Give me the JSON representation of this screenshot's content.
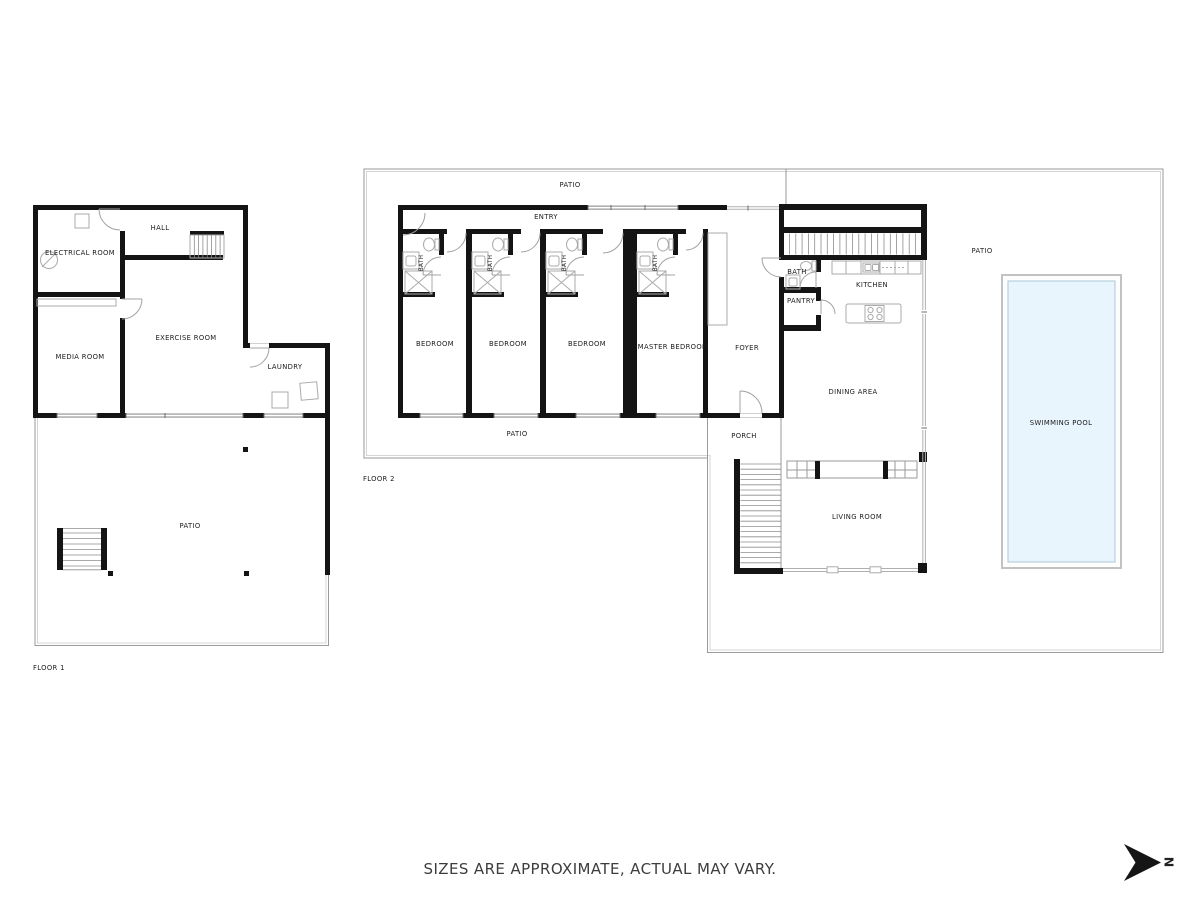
{
  "disclaimer": "SIZES ARE APPROXIMATE, ACTUAL MAY VARY.",
  "north": {
    "letter": "N"
  },
  "colors": {
    "wall": "#141414",
    "line": "#9a9a9a",
    "fixture": "#ababab",
    "pool_water": "#e9f5fc",
    "text": "#1b1b1b",
    "disclaimer": "#3d3d3d"
  },
  "floor1": {
    "label": "FLOOR 1",
    "rooms": {
      "electrical": "ELECTRICAL ROOM",
      "hall": "HALL",
      "media": "MEDIA ROOM",
      "exercise": "EXERCISE ROOM",
      "laundry": "LAUNDRY",
      "patio": "PATIO"
    }
  },
  "floor2": {
    "label": "FLOOR 2",
    "rooms": {
      "patio_top": "PATIO",
      "entry": "ENTRY",
      "bath1": "BATH",
      "bath2": "BATH",
      "bath3": "BATH",
      "bath4": "BATH",
      "bedroom1": "BEDROOM",
      "bedroom2": "BEDROOM",
      "bedroom3": "BEDROOM",
      "master_bedroom": "MASTER BEDROOM",
      "foyer": "FOYER",
      "patio_wing": "PATIO",
      "porch": "PORCH",
      "bath5": "BATH",
      "pantry": "PANTRY",
      "kitchen": "KITCHEN",
      "dining": "DINING AREA",
      "living": "LIVING ROOM",
      "patio_right": "PATIO",
      "pool": "SWIMMING POOL"
    }
  }
}
